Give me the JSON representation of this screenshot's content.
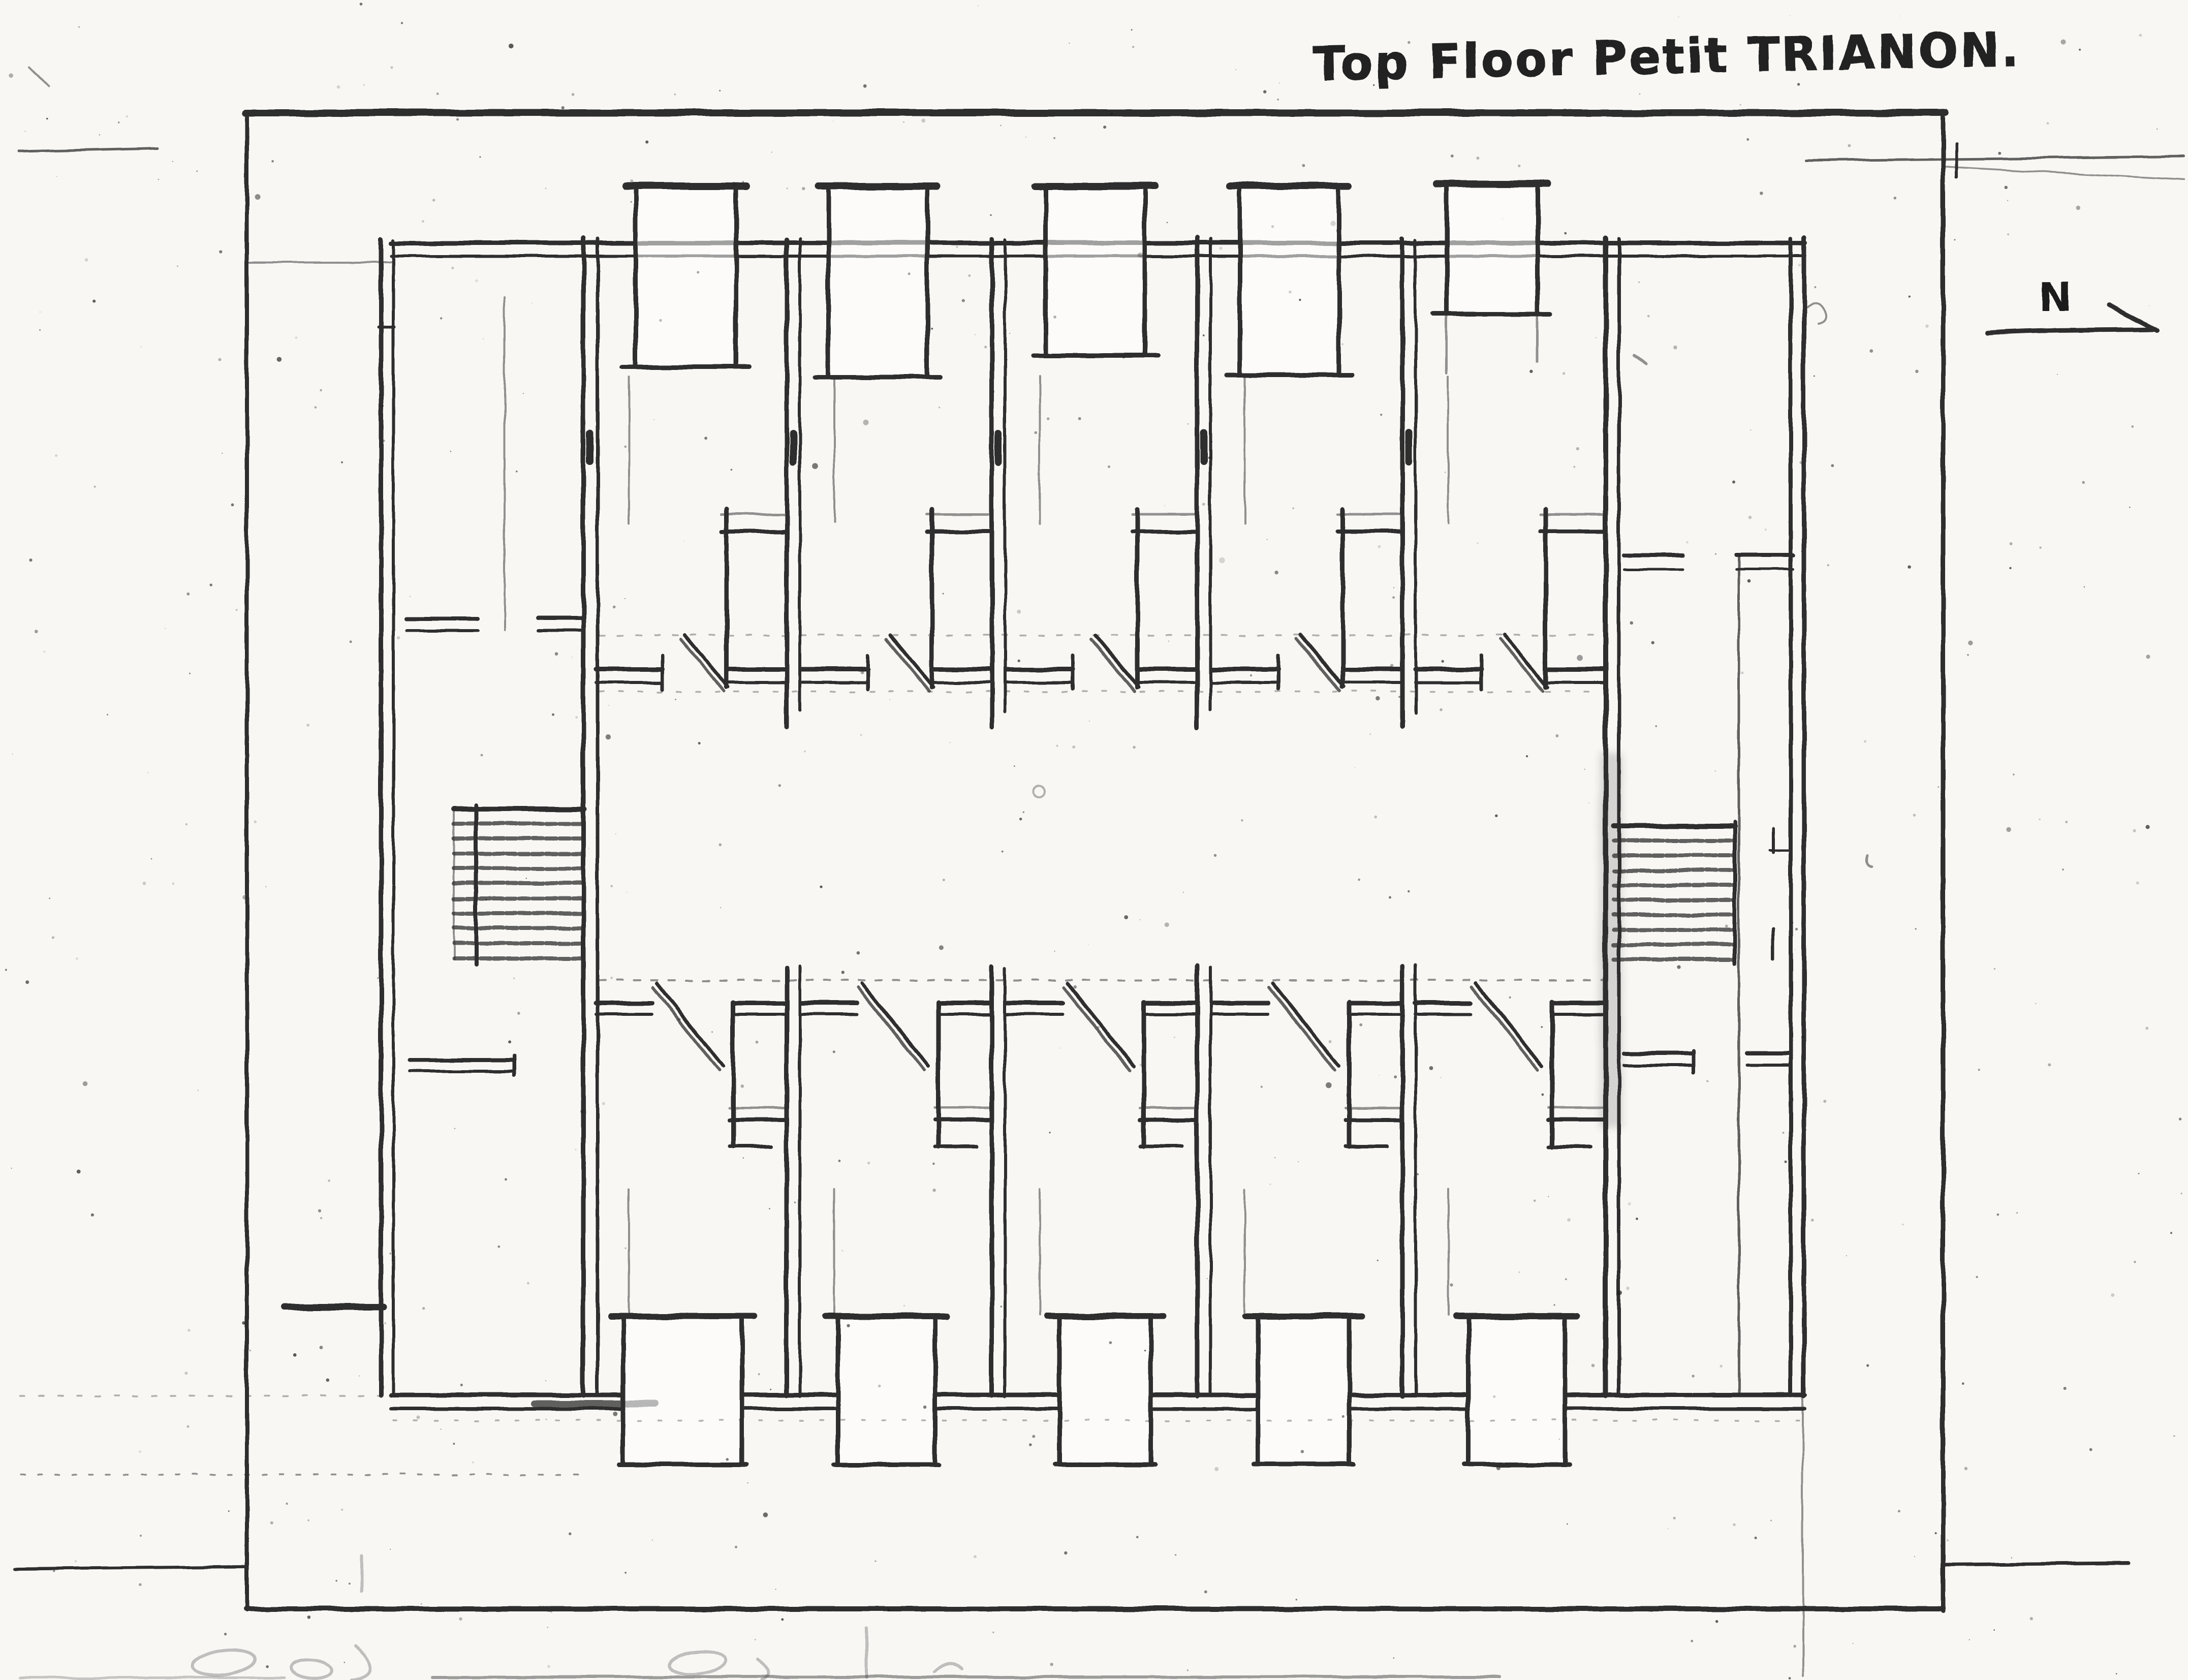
{
  "page": {
    "title": "Top Floor Petit TRIANON."
  },
  "compass": {
    "label": "N"
  }
}
